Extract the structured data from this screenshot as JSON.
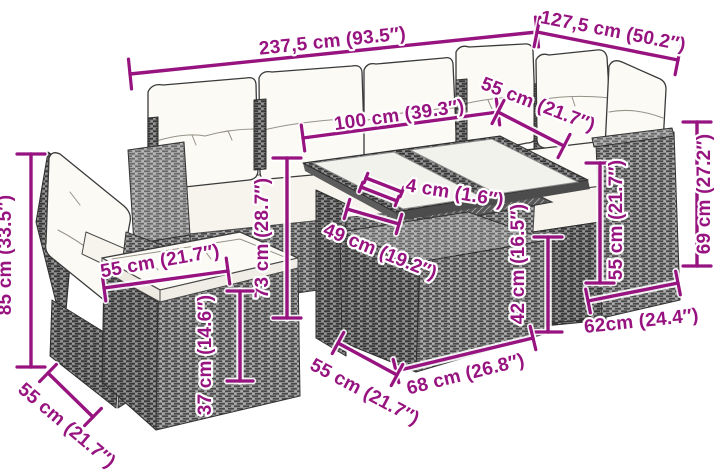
{
  "colors": {
    "accent": "#97137F",
    "rattan_gray": "#8f8f8f",
    "cushion_white": "#fbfaf5",
    "background": "#ffffff"
  },
  "figure": {
    "subject": "corner-sofa-set-with-table-dimension-diagram"
  },
  "dimensions": [
    {
      "id": "sofa-long-width",
      "label": "237,5 cm (93.5″)"
    },
    {
      "id": "sofa-right-width",
      "label": "127,5 cm (50.2″)"
    },
    {
      "id": "table-length",
      "label": "100 cm (39.3″)"
    },
    {
      "id": "corner-seat-width",
      "label": "55 cm (21.7″)"
    },
    {
      "id": "tabletop-thickness",
      "label": "4 cm (1.6″)"
    },
    {
      "id": "table-height",
      "label": "73 cm (28.7″)"
    },
    {
      "id": "table-depth",
      "label": "49 cm (19.2″)"
    },
    {
      "id": "footstool-height",
      "label": "42 cm (16.5″)"
    },
    {
      "id": "armrest-height",
      "label": "55 cm (21.7″)"
    },
    {
      "id": "backrest-height",
      "label": "69 cm (27.2″)"
    },
    {
      "id": "right-seat-depth",
      "label": "62cm (24.4″)"
    },
    {
      "id": "footstool-width",
      "label": "68 cm (26.8″)"
    },
    {
      "id": "footstool-depth",
      "label": "55 cm (21.7″)"
    },
    {
      "id": "ottoman-width",
      "label": "55 cm (21.7″)"
    },
    {
      "id": "chair-seat-depth",
      "label": "55 cm (21.7″)"
    },
    {
      "id": "chair-height",
      "label": "85 cm (33.5″)"
    },
    {
      "id": "ottoman-base-height",
      "label": "37 cm (14.6″)"
    }
  ]
}
